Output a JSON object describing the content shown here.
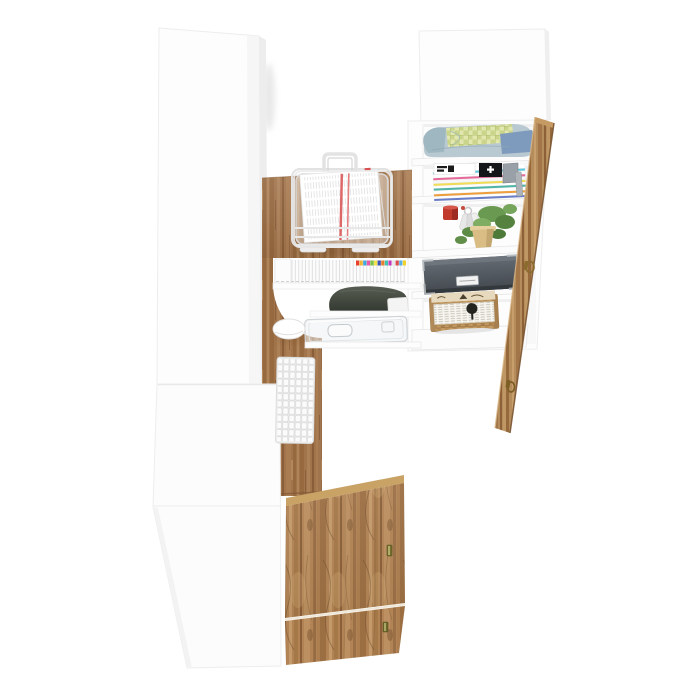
{
  "meta": {
    "type": "furniture-product-render",
    "description": "White corner desk workstation with wardrobe cabinet, open shelving unit, oak wood accents, keyboard, mouse, wire document tray, storage box, wicker basket and decor, shown rotated on a white background",
    "background": "#ffffff"
  },
  "palette": {
    "panel_white": "#fcfcfc",
    "panel_edge": "#ececec",
    "oak_base": "#a1744b",
    "oak_dark": "#8a5f3a",
    "oak_light": "#b58a5d",
    "craft_oak": "#b28455",
    "open_door_oak": "#b58c5b",
    "storage_box_gray": "#4d5359",
    "basket_tan": "#c49c63",
    "red_mug": "#c0392b",
    "paper_red_stripe": "#d94f4f",
    "brass_handle": "#8a6b2f",
    "denim_blue": "#7e9bbd",
    "plaid_green": "#cbd687",
    "plant_green": "#6a9a52"
  },
  "objects": {
    "wardrobe": {
      "label": "white wardrobe side panels"
    },
    "desk": {
      "label": "oak corner desk",
      "items": {
        "document_tray": "white wire document tray with papers",
        "mouse": "white computer mouse",
        "keyboard": "white keyboard",
        "media_row": "row of slim cases with colored caps",
        "dark_pouch": "dark storage pouch",
        "acrylic_tray": "clear acrylic tray"
      },
      "dvd_cap_colors": [
        "#e8412c",
        "#f2b632",
        "#3fa9dc",
        "#e858a8",
        "#7dc243",
        "#f2e24c",
        "#4053b2",
        "#e87f2f",
        "#42c4b0",
        "#c43fc0",
        "#e8e8e8",
        "#d94f4f",
        "#58b2e8",
        "#f2d22c"
      ]
    },
    "bookcase": {
      "label": "open shelf unit",
      "shelves": [
        "folded clothes",
        "magazine stack",
        "mug keys and potted plant",
        "dark storage box",
        "wicker basket with newspaper liner"
      ],
      "magazine_spines": [
        {
          "c": "#ffffff",
          "h": 4
        },
        {
          "c": "#5bc8dd",
          "h": 2
        },
        {
          "c": "#ffffff",
          "h": 3
        },
        {
          "c": "#e86a9a",
          "h": 2
        },
        {
          "c": "#f6f6f6",
          "h": 3
        },
        {
          "c": "#f2dd55",
          "h": 2
        },
        {
          "c": "#ffffff",
          "h": 2
        },
        {
          "c": "#4fb6a8",
          "h": 2
        },
        {
          "c": "#ffffff",
          "h": 3
        },
        {
          "c": "#ef9f3c",
          "h": 2
        },
        {
          "c": "#ffffff",
          "h": 2
        },
        {
          "c": "#6a7ec9",
          "h": 2
        }
      ]
    },
    "doors": {
      "open_door": "oak door ajar with brass handles",
      "bottom_door_count": 2
    }
  }
}
